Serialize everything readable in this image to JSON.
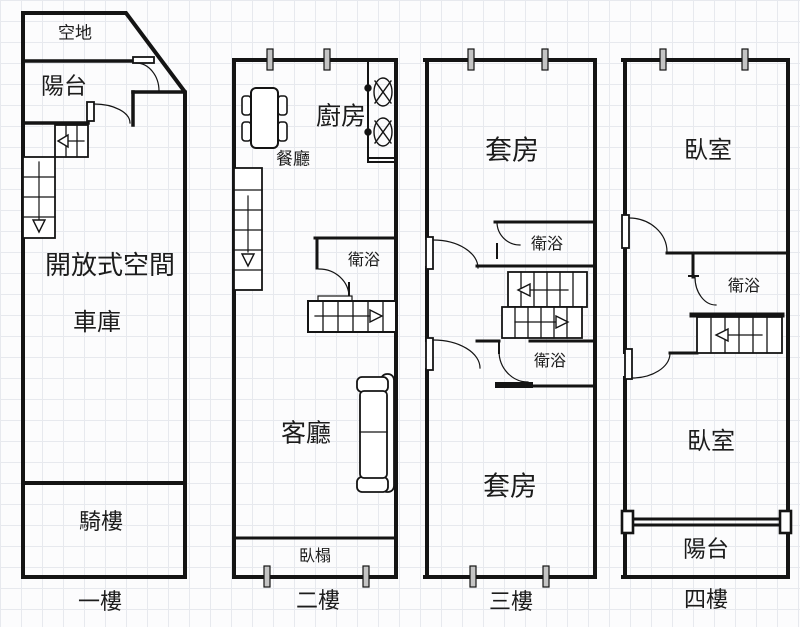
{
  "plan_title": "四層樓透天厝平面圖",
  "floors": [
    {
      "name": "一樓",
      "rooms": {
        "vacant_lot": "空地",
        "balcony": "陽台",
        "open_space": "開放式空間",
        "garage": "車庫",
        "arcade": "騎樓"
      }
    },
    {
      "name": "二樓",
      "rooms": {
        "dining": "餐廳",
        "kitchen": "廚房",
        "bath": "衛浴",
        "living": "客廳",
        "daybed": "臥榻"
      }
    },
    {
      "name": "三樓",
      "rooms": {
        "suite_top": "套房",
        "bath_top": "衛浴",
        "bath_bottom": "衛浴",
        "suite_bottom": "套房"
      }
    },
    {
      "name": "四樓",
      "rooms": {
        "bedroom_top": "臥室",
        "bath": "衛浴",
        "bedroom_bottom": "臥室",
        "balcony": "陽台"
      }
    }
  ],
  "colors": {
    "wall": "#141414",
    "grid": "#e7e9ee",
    "paper": "#fcfcfd",
    "text": "#1c1c1c"
  }
}
